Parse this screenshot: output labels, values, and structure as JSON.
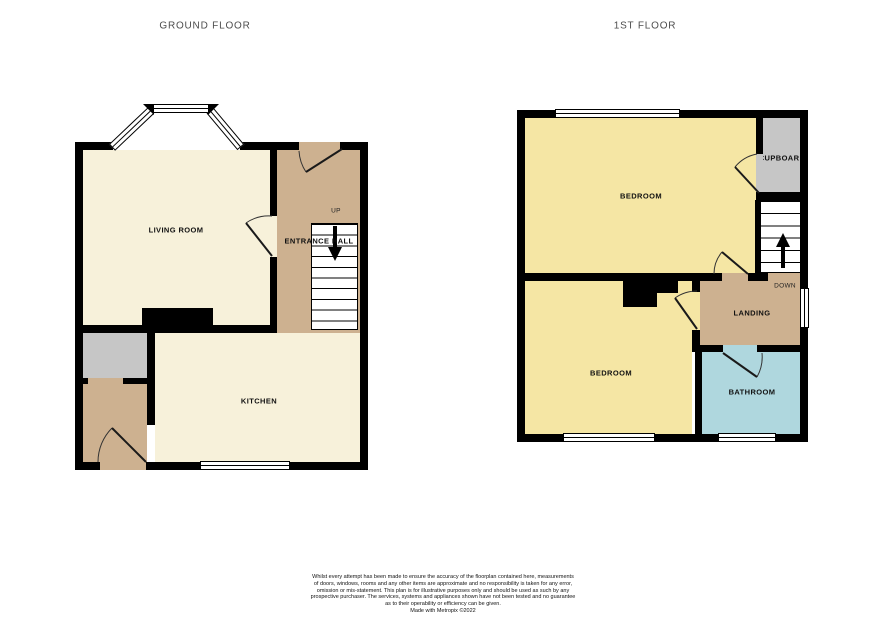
{
  "ground_floor": {
    "title": "GROUND FLOOR",
    "rooms": {
      "living_room": "LIVING ROOM",
      "entrance_hall": "ENTRANCE HALL",
      "kitchen": "KITCHEN"
    },
    "stairs": {
      "direction_label": "UP"
    }
  },
  "first_floor": {
    "title": "1ST FLOOR",
    "rooms": {
      "bedroom_front": "BEDROOM",
      "bedroom_back": "BEDROOM",
      "cupboard": "CUPBOARD",
      "landing": "LANDING",
      "bathroom": "BATHROOM"
    },
    "stairs": {
      "direction_label": "DOWN"
    }
  },
  "colors": {
    "room_cream": "#f7f1da",
    "room_yellow": "#f5e6a4",
    "hall_tan": "#cdb190",
    "bathroom_blue": "#afd7de",
    "cupboard_grey": "#c6c6c6",
    "wall_black": "#000000"
  },
  "footer": {
    "disclaimer_lines": [
      "Whilst every attempt has been made to ensure the accuracy of the floorplan contained here, measurements",
      "of doors, windows, rooms and any other items are approximate and no responsibility is taken for any error,",
      "omission or mis-statement. This plan is for illustrative purposes only and should be used as such by any",
      "prospective purchaser. The services, systems and appliances shown have not been tested and no guarantee",
      "as to their operability or efficiency can be given.",
      "Made with Metropix ©2022"
    ]
  }
}
